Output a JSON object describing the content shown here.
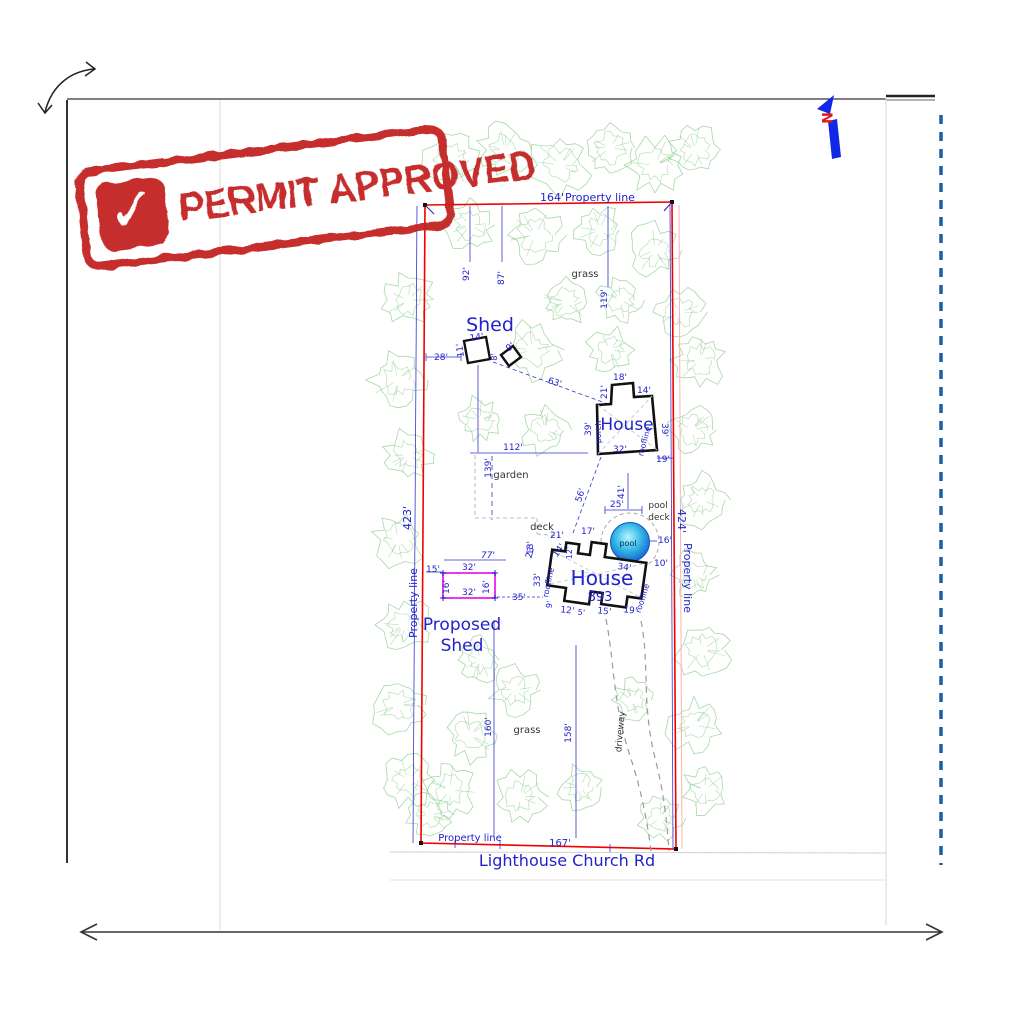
{
  "stamp": {
    "text": "PERMIT APPROVED",
    "check_glyph": "✓",
    "color": "#c42320"
  },
  "plan": {
    "road_name": "Lighthouse Church Rd",
    "colors": {
      "b": "#2222cc",
      "k": "#333333",
      "r": "#e01818",
      "n": "#002a66",
      "m": "#e822e8"
    },
    "labels": [
      {
        "n": "dim-label",
        "t": "164'",
        "x": 552,
        "y": 201,
        "s": 11
      },
      {
        "n": "property-line-label-top",
        "t": "Property line",
        "x": 600,
        "y": 201,
        "s": 11
      },
      {
        "n": "dim-label",
        "t": "423'",
        "x": 411,
        "y": 518,
        "r": -90,
        "s": 11
      },
      {
        "n": "property-line-label-left",
        "t": "Property line",
        "x": 417,
        "y": 603,
        "r": -90,
        "s": 11
      },
      {
        "n": "dim-label",
        "t": "424'",
        "x": 678,
        "y": 521,
        "r": 90,
        "s": 11
      },
      {
        "n": "property-line-label-right",
        "t": "Property line",
        "x": 684,
        "y": 578,
        "r": 90,
        "s": 11
      },
      {
        "n": "property-line-label-bottom",
        "t": "Property line",
        "x": 470,
        "y": 841,
        "s": 10
      },
      {
        "n": "dim-label",
        "t": "167'",
        "x": 560,
        "y": 846,
        "s": 10
      },
      {
        "n": "road-name",
        "t": "Lighthouse Church Rd",
        "x": 567,
        "y": 866,
        "s": 16
      },
      {
        "n": "dim-label",
        "t": "92'",
        "x": 469,
        "y": 274,
        "r": -90,
        "s": 9
      },
      {
        "n": "dim-label",
        "t": "87'",
        "x": 504,
        "y": 278,
        "r": -90,
        "s": 9
      },
      {
        "n": "dim-label",
        "t": "119'",
        "x": 607,
        "y": 299,
        "r": -90,
        "s": 9
      },
      {
        "n": "grass-label-top",
        "t": "grass",
        "x": 585,
        "y": 277,
        "c": "k",
        "s": 10
      },
      {
        "n": "shed-label",
        "t": "Shed",
        "x": 490,
        "y": 331,
        "s": 19
      },
      {
        "n": "dim-label",
        "t": "14'",
        "x": 477,
        "y": 340,
        "r": -8,
        "s": 9
      },
      {
        "n": "dim-label",
        "t": "11'",
        "x": 463,
        "y": 350,
        "r": -98,
        "s": 9
      },
      {
        "n": "dim-label",
        "t": "28'",
        "x": 441,
        "y": 360,
        "s": 9
      },
      {
        "n": "dim-label",
        "t": "9'",
        "x": 512,
        "y": 349,
        "r": -40,
        "s": 9
      },
      {
        "n": "dim-label",
        "t": "8'",
        "x": 497,
        "y": 357,
        "r": -90,
        "s": 8
      },
      {
        "n": "dim-label",
        "t": "63'",
        "x": 554,
        "y": 385,
        "r": 17,
        "s": 9
      },
      {
        "n": "upper-house-label",
        "t": "House",
        "x": 627,
        "y": 430,
        "s": 17
      },
      {
        "n": "dim-label",
        "t": "18'",
        "x": 620,
        "y": 380,
        "s": 9
      },
      {
        "n": "dim-label",
        "t": "21'",
        "x": 607,
        "y": 392,
        "r": -90,
        "s": 9
      },
      {
        "n": "dim-label",
        "t": "14'",
        "x": 644,
        "y": 393,
        "s": 9
      },
      {
        "n": "dim-label",
        "t": "39'",
        "x": 591,
        "y": 429,
        "r": -90,
        "s": 9
      },
      {
        "n": "porch-label",
        "t": "porch",
        "x": 601,
        "y": 432,
        "r": -90,
        "s": 8
      },
      {
        "n": "dim-label",
        "t": "39'",
        "x": 662,
        "y": 430,
        "r": 90,
        "s": 9
      },
      {
        "n": "roofline-label",
        "t": "roofline",
        "x": 647,
        "y": 442,
        "r": -75,
        "s": 8
      },
      {
        "n": "dim-label",
        "t": "32'",
        "x": 620,
        "y": 452,
        "s": 9
      },
      {
        "n": "dim-label",
        "t": "19'",
        "x": 663,
        "y": 462,
        "s": 9
      },
      {
        "n": "dim-label",
        "t": "112'",
        "x": 513,
        "y": 450,
        "s": 9
      },
      {
        "n": "dim-label",
        "t": "139'",
        "x": 491,
        "y": 468,
        "r": -90,
        "s": 9
      },
      {
        "n": "garden-label",
        "t": "garden",
        "x": 511,
        "y": 478,
        "c": "k",
        "s": 10
      },
      {
        "n": "deck-label",
        "t": "deck",
        "x": 542,
        "y": 530,
        "c": "k",
        "s": 10
      },
      {
        "n": "dim-label",
        "t": "56'",
        "x": 583,
        "y": 496,
        "r": -72,
        "s": 9
      },
      {
        "n": "dim-label",
        "t": "41'",
        "x": 624,
        "y": 492,
        "r": -90,
        "s": 9
      },
      {
        "n": "dim-label",
        "t": "25'",
        "x": 617,
        "y": 507,
        "s": 9
      },
      {
        "n": "pool-deck-label-1",
        "t": "pool",
        "x": 658,
        "y": 508,
        "c": "k",
        "s": 9
      },
      {
        "n": "pool-deck-label-2",
        "t": "deck",
        "x": 659,
        "y": 520,
        "c": "k",
        "s": 9
      },
      {
        "n": "dim-label",
        "t": "16'",
        "x": 665,
        "y": 543,
        "s": 9
      },
      {
        "n": "pool-label",
        "t": "pool",
        "x": 628,
        "y": 546,
        "c": "n",
        "s": 8
      },
      {
        "n": "dim-label",
        "t": "10'",
        "x": 661,
        "y": 566,
        "s": 9
      },
      {
        "n": "dim-label",
        "t": "34'",
        "x": 624,
        "y": 570,
        "r": 8,
        "s": 9
      },
      {
        "n": "dim-label",
        "t": "17'",
        "x": 588,
        "y": 534,
        "s": 9
      },
      {
        "n": "dim-label",
        "t": "21'",
        "x": 557,
        "y": 538,
        "s": 9
      },
      {
        "n": "dim-label",
        "t": "13'",
        "x": 533,
        "y": 548,
        "r": -90,
        "s": 9
      },
      {
        "n": "dim-label",
        "t": "14'",
        "x": 561,
        "y": 552,
        "r": -55,
        "s": 9
      },
      {
        "n": "dim-label",
        "t": "12'",
        "x": 572,
        "y": 553,
        "r": -90,
        "s": 8
      },
      {
        "n": "dim-label",
        "t": "33'",
        "x": 540,
        "y": 580,
        "r": -90,
        "s": 9
      },
      {
        "n": "roofline-label",
        "t": "roofline",
        "x": 551,
        "y": 583,
        "r": -78,
        "s": 8
      },
      {
        "n": "lower-house-label",
        "t": "House",
        "x": 602,
        "y": 585,
        "s": 20
      },
      {
        "n": "house-number",
        "t": "893",
        "x": 600,
        "y": 601,
        "s": 13
      },
      {
        "n": "roofline-label",
        "t": "roofline",
        "x": 645,
        "y": 599,
        "r": -72,
        "s": 8
      },
      {
        "n": "dim-label",
        "t": "9'",
        "x": 552,
        "y": 605,
        "r": -80,
        "s": 8
      },
      {
        "n": "dim-label",
        "t": "12'",
        "x": 567,
        "y": 613,
        "r": 6,
        "s": 9
      },
      {
        "n": "dim-label",
        "t": "5'",
        "x": 581,
        "y": 615,
        "r": 6,
        "s": 8
      },
      {
        "n": "dim-label",
        "t": "15'",
        "x": 604,
        "y": 614,
        "r": 6,
        "s": 9
      },
      {
        "n": "dim-label",
        "t": "19'",
        "x": 630,
        "y": 613,
        "r": 6,
        "s": 9
      },
      {
        "n": "dim-label",
        "t": "35'",
        "x": 519,
        "y": 600,
        "s": 9
      },
      {
        "n": "dim-label",
        "t": "32'",
        "x": 469,
        "y": 570,
        "s": 9
      },
      {
        "n": "dim-label",
        "t": "32'",
        "x": 469,
        "y": 595,
        "s": 9
      },
      {
        "n": "dim-label",
        "t": "16'",
        "x": 449,
        "y": 587,
        "r": -90,
        "s": 9
      },
      {
        "n": "dim-label",
        "t": "16'",
        "x": 489,
        "y": 587,
        "r": -90,
        "s": 9
      },
      {
        "n": "dim-label",
        "t": "15'",
        "x": 433,
        "y": 572,
        "s": 9
      },
      {
        "n": "dim-label",
        "t": "77'",
        "x": 488,
        "y": 558,
        "s": 9,
        "i": 1
      },
      {
        "n": "dim-label",
        "t": "23'",
        "x": 533,
        "y": 552,
        "r": -75,
        "s": 9
      },
      {
        "n": "proposed-shed-label-1",
        "t": "Proposed",
        "x": 462,
        "y": 630,
        "s": 17
      },
      {
        "n": "proposed-shed-label-2",
        "t": "Shed",
        "x": 462,
        "y": 651,
        "s": 17
      },
      {
        "n": "driveway-label",
        "t": "driveway",
        "x": 623,
        "y": 732,
        "r": -85,
        "c": "k",
        "s": 9
      },
      {
        "n": "dim-label",
        "t": "158'",
        "x": 571,
        "y": 733,
        "r": -90,
        "s": 9
      },
      {
        "n": "dim-label",
        "t": "160'",
        "x": 491,
        "y": 727,
        "r": -90,
        "s": 9
      },
      {
        "n": "grass-label-bottom",
        "t": "grass",
        "x": 527,
        "y": 733,
        "c": "k",
        "s": 10
      },
      {
        "n": "north-label",
        "t": "N",
        "x": 822,
        "y": 118,
        "r": 90,
        "c": "r",
        "s": 14,
        "w": 1
      }
    ],
    "trees": [
      [
        452,
        160,
        30
      ],
      [
        505,
        150,
        26
      ],
      [
        560,
        165,
        30
      ],
      [
        610,
        148,
        26
      ],
      [
        655,
        165,
        28
      ],
      [
        695,
        150,
        24
      ],
      [
        470,
        225,
        26
      ],
      [
        535,
        235,
        28
      ],
      [
        600,
        230,
        24
      ],
      [
        655,
        250,
        26
      ],
      [
        620,
        300,
        22
      ],
      [
        680,
        312,
        24
      ],
      [
        408,
        300,
        26
      ],
      [
        398,
        380,
        28
      ],
      [
        408,
        455,
        24
      ],
      [
        398,
        540,
        26
      ],
      [
        404,
        625,
        26
      ],
      [
        398,
        705,
        28
      ],
      [
        408,
        780,
        26
      ],
      [
        430,
        815,
        22
      ],
      [
        700,
        360,
        26
      ],
      [
        692,
        430,
        24
      ],
      [
        702,
        500,
        26
      ],
      [
        694,
        575,
        24
      ],
      [
        702,
        650,
        28
      ],
      [
        694,
        725,
        26
      ],
      [
        705,
        790,
        24
      ],
      [
        660,
        818,
        22
      ],
      [
        532,
        350,
        28
      ],
      [
        566,
        302,
        24
      ],
      [
        480,
        420,
        22
      ],
      [
        545,
        430,
        24
      ],
      [
        610,
        350,
        22
      ],
      [
        480,
        660,
        22
      ],
      [
        515,
        690,
        24
      ],
      [
        470,
        735,
        26
      ],
      [
        450,
        790,
        26
      ],
      [
        520,
        797,
        26
      ],
      [
        580,
        787,
        22
      ],
      [
        632,
        700,
        20
      ]
    ]
  }
}
